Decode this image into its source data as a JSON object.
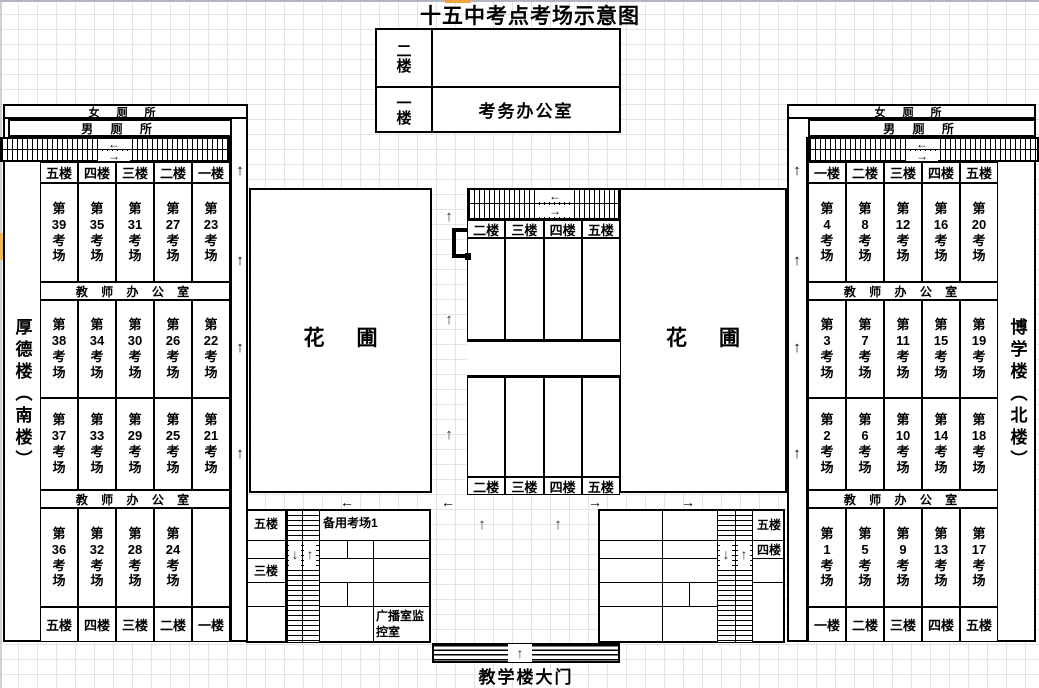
{
  "title": "十五中考点考场示意图",
  "glyphs": {
    "up": "↑",
    "down": "↓",
    "left": "←",
    "right": "→"
  },
  "labels": {
    "di": "第",
    "kao": "考",
    "chang": "场",
    "women": "女 厕 所",
    "men": "男 厕 所",
    "teacher_office": "教 师 办 公 室",
    "hua": "花",
    "pu": "圃"
  },
  "office_building": {
    "floor2": "二楼",
    "floor1": "一楼",
    "room": "考务办公室"
  },
  "left_building": {
    "name": "厚德楼（南楼）",
    "floors_top": [
      "五楼",
      "四楼",
      "三楼",
      "二楼",
      "一楼"
    ],
    "floors_bottom": [
      "五楼",
      "四楼",
      "三楼",
      "二楼",
      "一楼"
    ],
    "rooms": [
      [
        "39",
        "35",
        "31",
        "27",
        "23"
      ],
      [
        "38",
        "34",
        "30",
        "26",
        "22"
      ],
      [
        "37",
        "33",
        "29",
        "25",
        "21"
      ],
      [
        "36",
        "32",
        "28",
        "24"
      ]
    ]
  },
  "right_building": {
    "name": "博学楼（北楼）",
    "floors_top": [
      "一楼",
      "二楼",
      "三楼",
      "四楼",
      "五楼"
    ],
    "floors_bottom": [
      "一楼",
      "二楼",
      "三楼",
      "四楼",
      "五楼"
    ],
    "rooms": [
      [
        "4",
        "8",
        "12",
        "16",
        "20"
      ],
      [
        "3",
        "7",
        "11",
        "15",
        "19"
      ],
      [
        "2",
        "6",
        "10",
        "14",
        "18"
      ],
      [
        "1",
        "5",
        "9",
        "13",
        "17"
      ]
    ]
  },
  "central_building": {
    "floors": [
      "二楼",
      "三楼",
      "四楼",
      "五楼"
    ]
  },
  "bottom_left_block": {
    "floor5": "五楼",
    "floor3": "三楼",
    "backup": "备用考场1",
    "broadcast": "广播室监控室"
  },
  "bottom_right_block": {
    "floor5": "五楼",
    "floor4": "四楼"
  },
  "gate": {
    "label": "教学楼大门"
  },
  "colors": {
    "accent_orange": "#f2a43c",
    "line": "#000000",
    "grid": "#e4e4e7"
  }
}
